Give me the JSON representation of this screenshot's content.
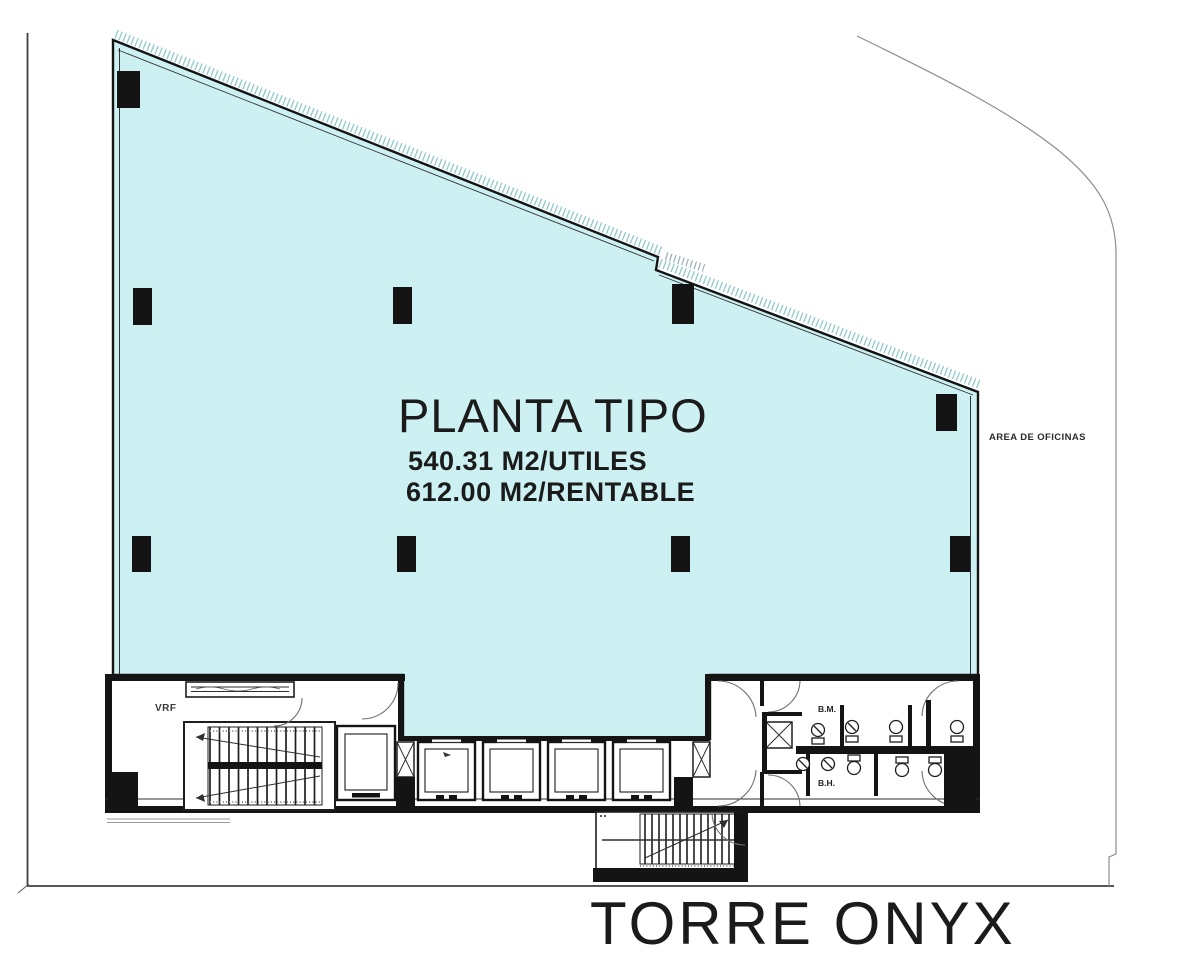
{
  "plan": {
    "title": "PLANTA TIPO",
    "area_useful": "540.31 M2/UTILES",
    "area_rentable": "612.00 M2/RENTABLE"
  },
  "building": {
    "name": "TORRE ONYX"
  },
  "annotations": {
    "office_area": "AREA DE OFICINAS"
  },
  "rooms": {
    "vrf": "VRF",
    "bathroom_m": "B.M.",
    "bathroom_h": "B.H."
  },
  "colors": {
    "floor_fill": "#cdf1f2",
    "wall": "#141414",
    "hatch": "#8fc9cc",
    "boundary": "#4a4a4a",
    "boundary_light": "#8d8d8d"
  }
}
